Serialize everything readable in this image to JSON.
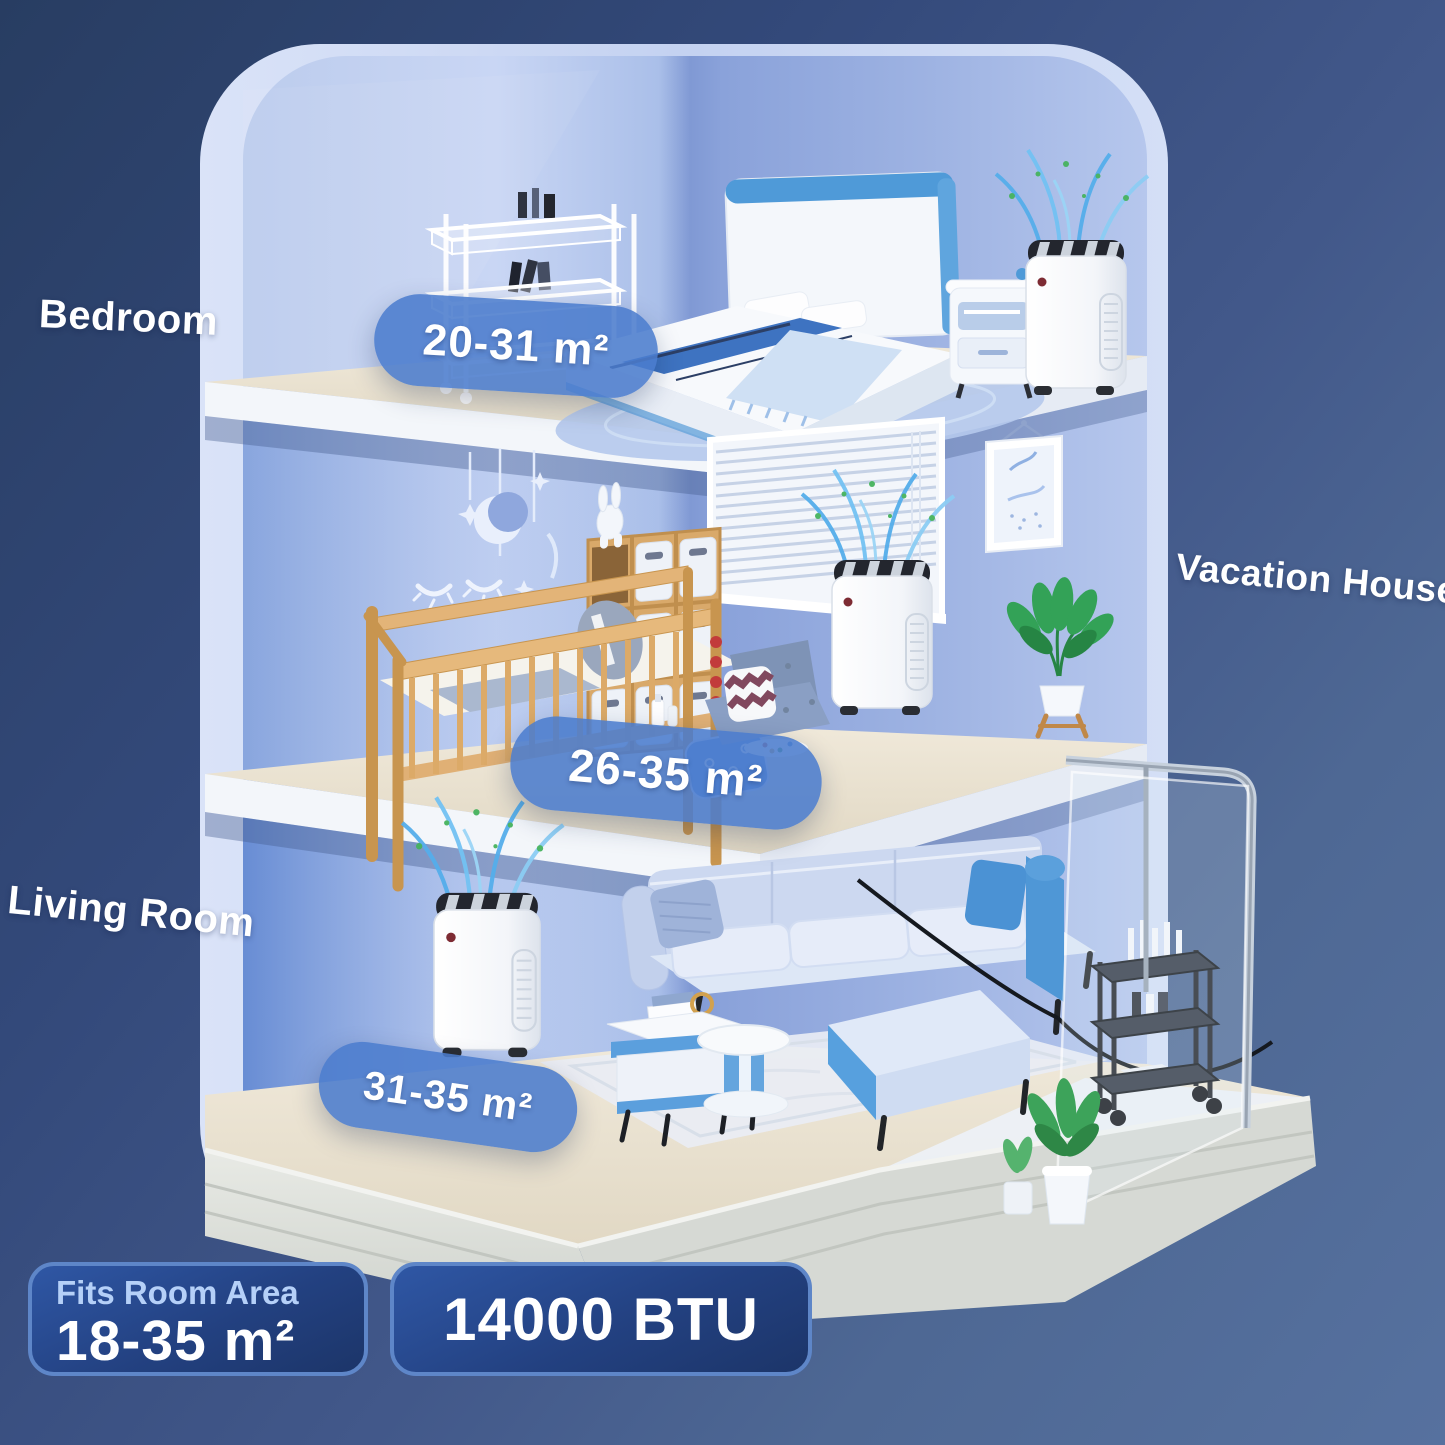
{
  "rooms": [
    {
      "name": "bedroom",
      "label": "Bedroom",
      "area": "20-31 m²"
    },
    {
      "name": "vacation-house",
      "label": "Vacation House",
      "area": "26-35 m²"
    },
    {
      "name": "living-room",
      "label": "Living Room",
      "area": "31-35 m²"
    }
  ],
  "specs": {
    "fits_room_area_label": "Fits Room Area",
    "fits_room_area_value": "18-35 m²",
    "btu": "14000 BTU"
  },
  "scene": {
    "bedroom_items": [
      "wire-storage-cart",
      "double-bed",
      "nightstand",
      "portable-air-conditioner",
      "rug"
    ],
    "vacation_house_items": [
      "moon-mobile",
      "sleepy-eyes-decal",
      "window-blinds",
      "wall-art",
      "baby-crib",
      "cube-storage-with-bins",
      "bunny-plush",
      "portable-air-conditioner",
      "potted-plant",
      "floor-cushion",
      "chevron-pillow"
    ],
    "living_room_items": [
      "portable-air-conditioner",
      "sectional-sofa",
      "coffee-table",
      "round-side-table",
      "area-rug",
      "glass-balcony",
      "bar-cart",
      "potted-plants"
    ]
  },
  "colors": {
    "background_top_left": "#2b4066",
    "background_bottom_right": "#56719f",
    "wall_light": "#c8d6f4",
    "wall_shadow": "#8099d4",
    "floor_wood": "#eae2d2",
    "base_plinth": "#d6d9d4",
    "area_pill": "#4b7ccd",
    "spec_badge_top": "#2e55a2",
    "spec_badge_bottom": "#1d3a74",
    "spec_badge_border": "#5e86c8",
    "fits_label_text": "#b5d0f8",
    "airflow_blue": "#55aeeb",
    "airflow_green": "#46b35e"
  }
}
